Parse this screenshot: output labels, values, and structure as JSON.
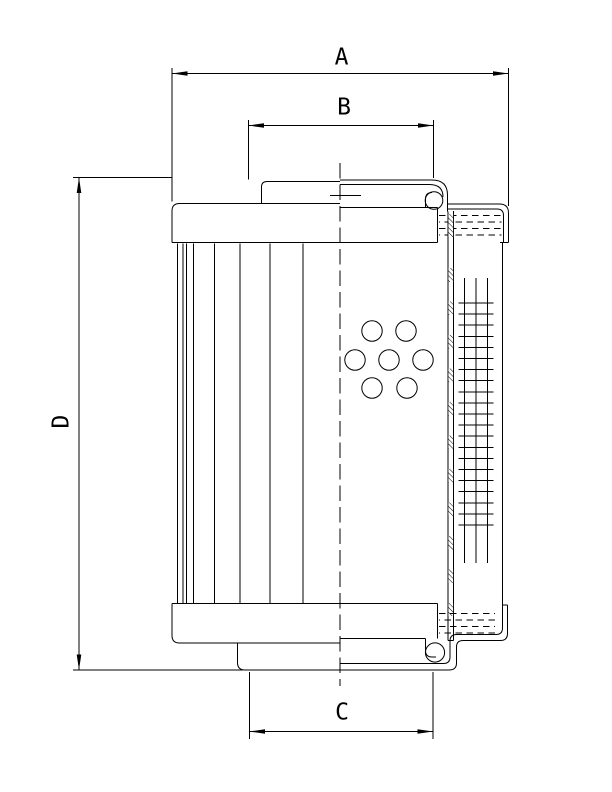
{
  "drawing": {
    "type": "technical-drawing-filter-element",
    "background": "#ffffff",
    "line_color": "#000000",
    "dimension_labels": {
      "a": "A",
      "b": "B",
      "c": "C",
      "d": "D"
    }
  }
}
